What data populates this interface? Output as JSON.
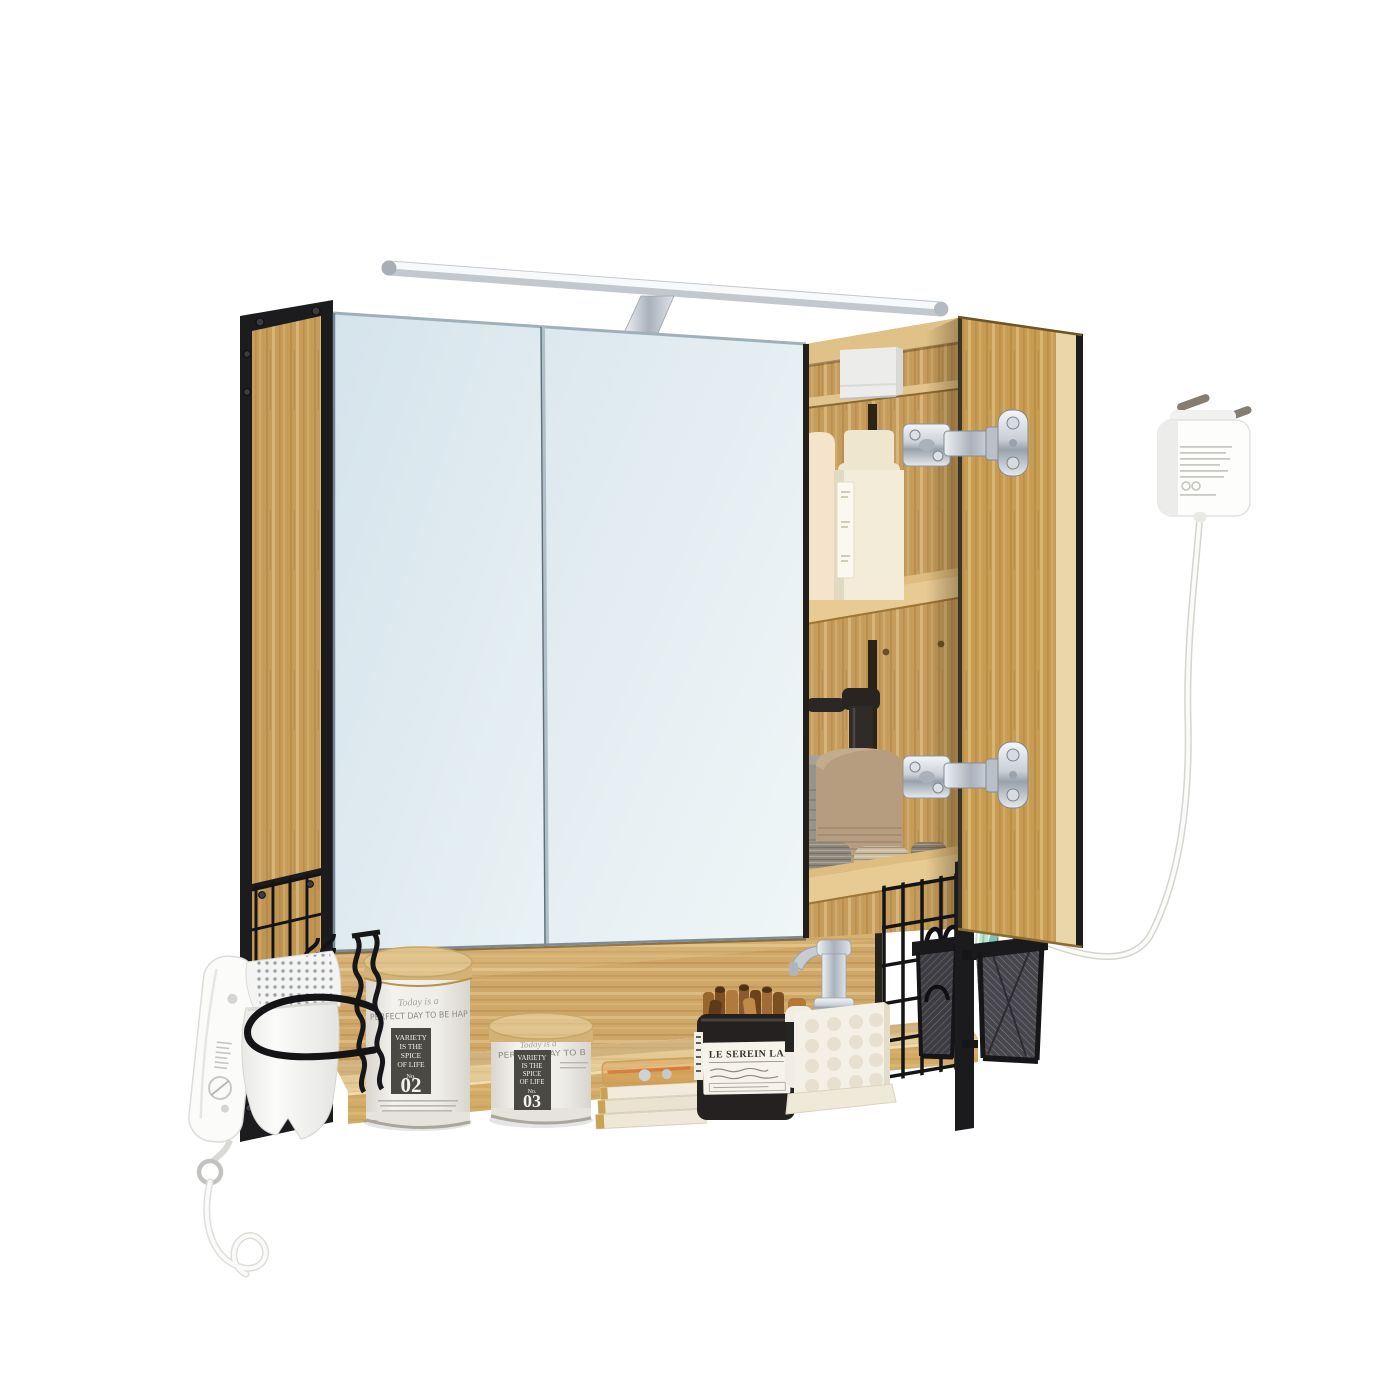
{
  "product": {
    "name": "Wall-mounted bathroom mirror cabinet, oak wood with black metal frame, LED light bar, open right door and bottom shelf",
    "scene": "product photo on white background"
  },
  "labels": {
    "canister02": {
      "script": "Today is a",
      "headline": "PERFECT DAY TO BE HAP",
      "badge_l1": "VARIETY",
      "badge_l2": "IS THE",
      "badge_l3": "SPICE",
      "badge_l4": "OF LIFE",
      "no": "No.",
      "num": "02"
    },
    "canister03": {
      "script": "Today is a",
      "headline": "PERFECT DAY TO B",
      "badge_l1": "VARIETY",
      "badge_l2": "IS THE",
      "badge_l3": "SPICE",
      "badge_l4": "OF LIFE",
      "no": "No.",
      "num": "03"
    },
    "jar": {
      "brand": "LE SEREIN LAB"
    }
  },
  "palette": {
    "background": "#ffffff",
    "oak": "#c9a05e",
    "oak_light": "#e3c08a",
    "frame_black": "#1b1b1e",
    "mirror_blue": "#dde9ef",
    "chrome": "#c9cfd6",
    "cream_bottle": "#f2e9d6",
    "ceramic_taupe": "#b79d80",
    "mesh_dark": "#3f3f44"
  },
  "objects": [
    "led-light-bar",
    "mirror-door-left",
    "mirror-door-right",
    "open-wood-door",
    "interior-shelves",
    "white-storage-box",
    "cream-bottles",
    "soap-dispenser-ceramic",
    "woven-baskets",
    "chrome-hinges",
    "power-plug-adapter",
    "power-cable",
    "storage-canister-02",
    "storage-canister-03",
    "stacked-trays",
    "cinnamon-jar",
    "soap-dispenser-chrome-pump",
    "brush-cup",
    "wire-grid-panels",
    "mesh-basket-hanging",
    "mesh-pen-cup",
    "toothbrushes",
    "hair-dryer",
    "hair-dryer-wire-holder",
    "s-hooks"
  ]
}
